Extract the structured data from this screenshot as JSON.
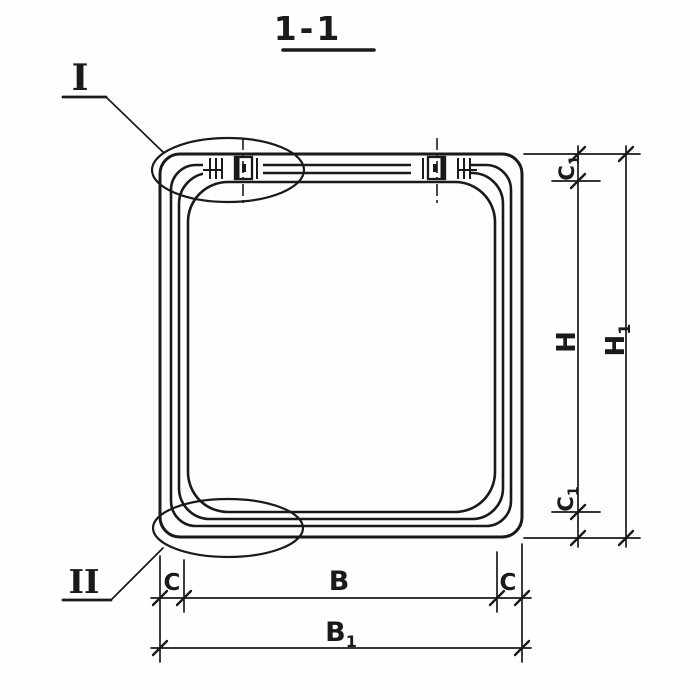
{
  "title": {
    "text": "1-1"
  },
  "callouts": {
    "detail_one": {
      "label": "I"
    },
    "detail_two": {
      "label": "II"
    }
  },
  "dimensions": {
    "width_inner": {
      "label": "B"
    },
    "width_outer": {
      "base": "B",
      "sub": "1"
    },
    "wall_left": {
      "label": "C"
    },
    "wall_right": {
      "label": "C"
    },
    "height_inner": {
      "label": "H"
    },
    "height_outer": {
      "base": "H",
      "sub": "1"
    },
    "wall_top": {
      "base": "C",
      "sub": "1"
    },
    "wall_bottom": {
      "base": "C",
      "sub": "1"
    }
  },
  "colors": {
    "ink": "#1a1a1a",
    "paper": "#fefefe"
  }
}
